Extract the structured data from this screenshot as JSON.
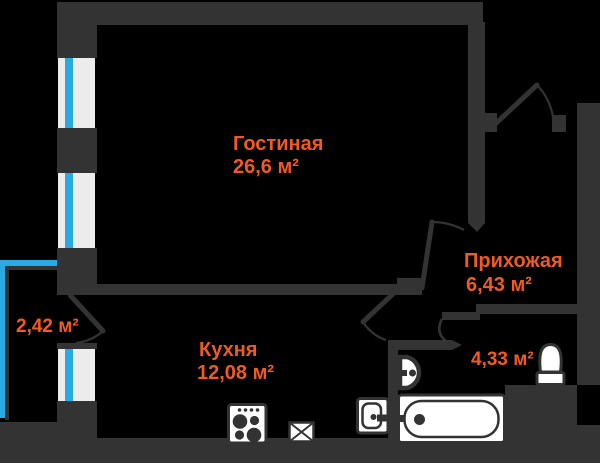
{
  "colors": {
    "background": "#000000",
    "wall": "#333333",
    "window": "#ececec",
    "glazing": "#29abe2",
    "label": "#f15a24",
    "fixture": "#ffffff"
  },
  "rooms": {
    "living": {
      "name": "Гостиная",
      "area": "26,6 м²"
    },
    "hallway": {
      "name": "Прихожая",
      "area": "6,43 м²"
    },
    "kitchen": {
      "name": "Кухня",
      "area": "12,08 м²"
    },
    "bathroom": {
      "area": "4,33 м²"
    },
    "balcony": {
      "area": "2,42 м²"
    }
  },
  "fixtures": {
    "bathtub": "bathtub-icon",
    "toilet": "toilet-icon",
    "washbasin": "washbasin-icon",
    "washing_machine": "washing-machine-icon",
    "stove": "stove-icon",
    "sink": "kitchen-sink-icon"
  },
  "doors": [
    "entrance-door",
    "living-room-door",
    "kitchen-door",
    "bathroom-door",
    "balcony-door"
  ]
}
